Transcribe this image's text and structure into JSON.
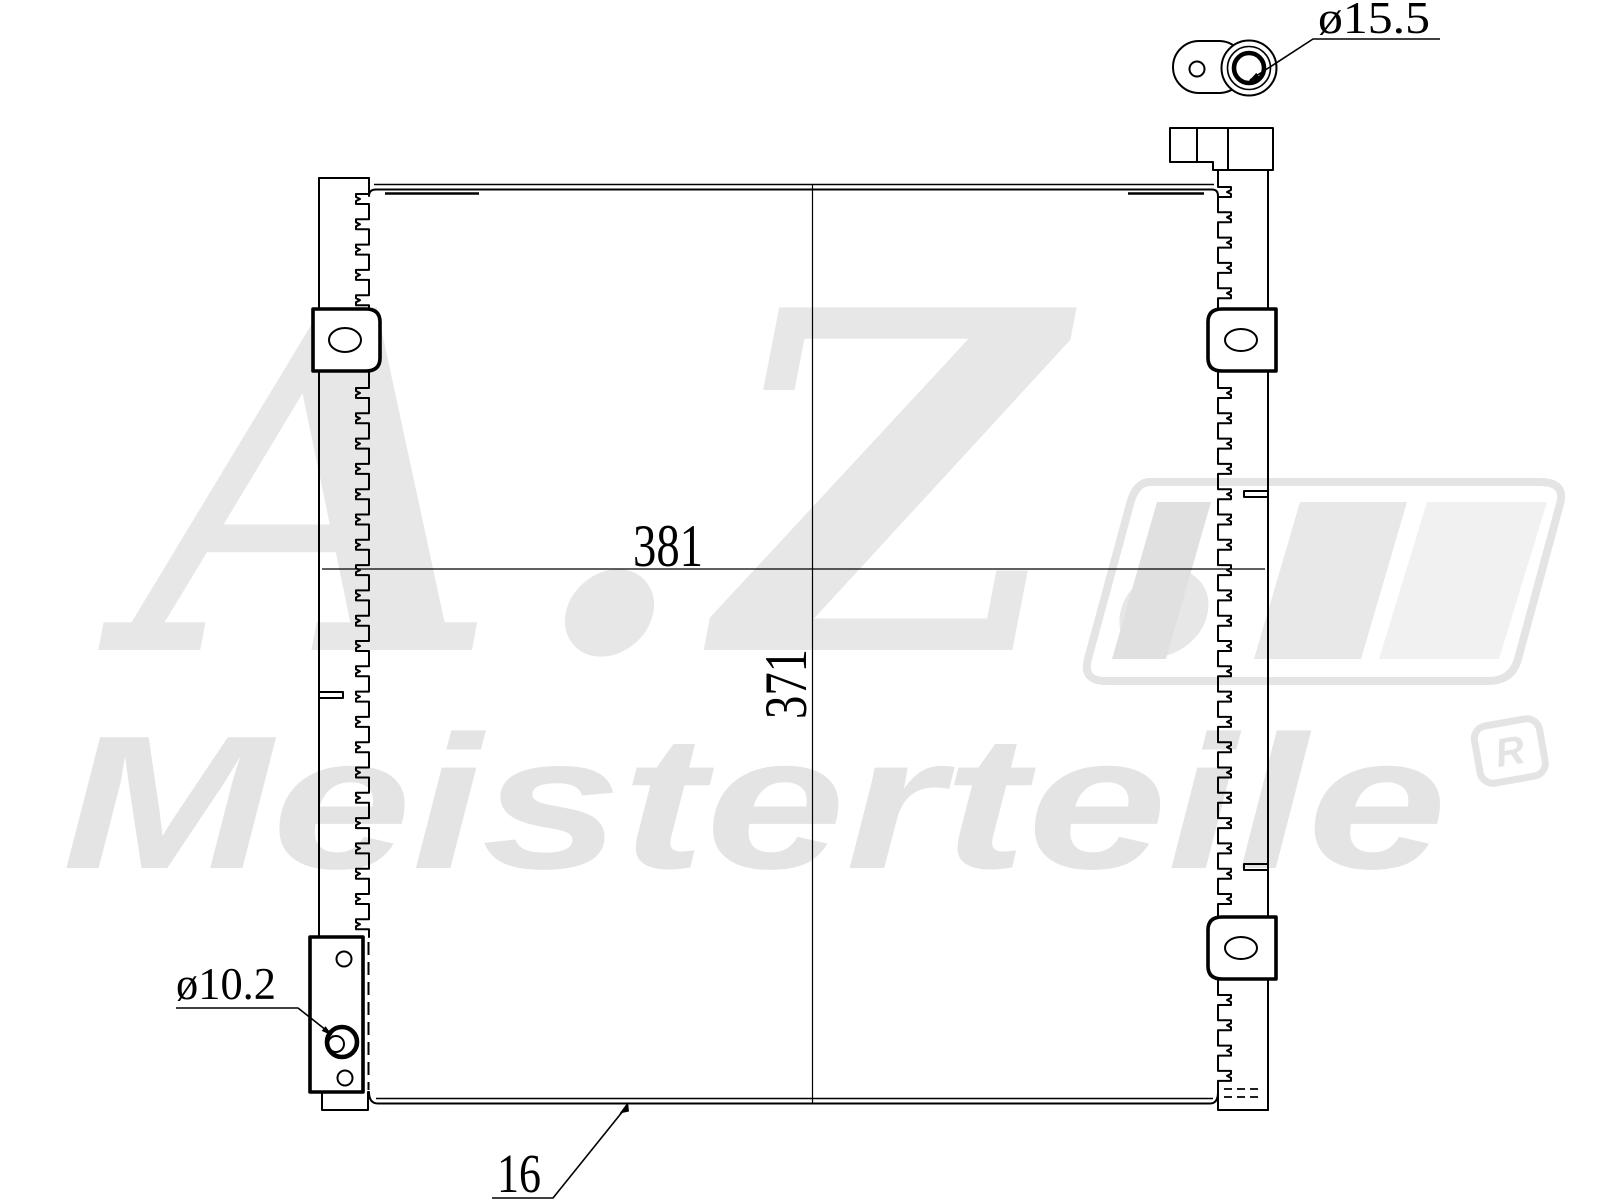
{
  "page": {
    "background": "#ffffff",
    "description": "technical line drawing of an air-conditioning condenser with dimensions"
  },
  "watermark": {
    "script_text": "A.Z.",
    "wordmark_text": "Meisterteile",
    "registered_mark": "R",
    "script_color": "#e7e7e7",
    "wordmark_color": "#e4e4e4",
    "logo_outline_color": "#e4e4e4",
    "logo_bar_colors": [
      "#e0e0e0",
      "#e8e8e8",
      "#f1f1f1"
    ]
  },
  "drawing": {
    "line_color": "#000000",
    "labels": {
      "core_width": "381",
      "core_height": "371",
      "core_depth": "16",
      "top_port_diameter": "ø15.5",
      "bottom_port_diameter": "ø10.2"
    }
  }
}
